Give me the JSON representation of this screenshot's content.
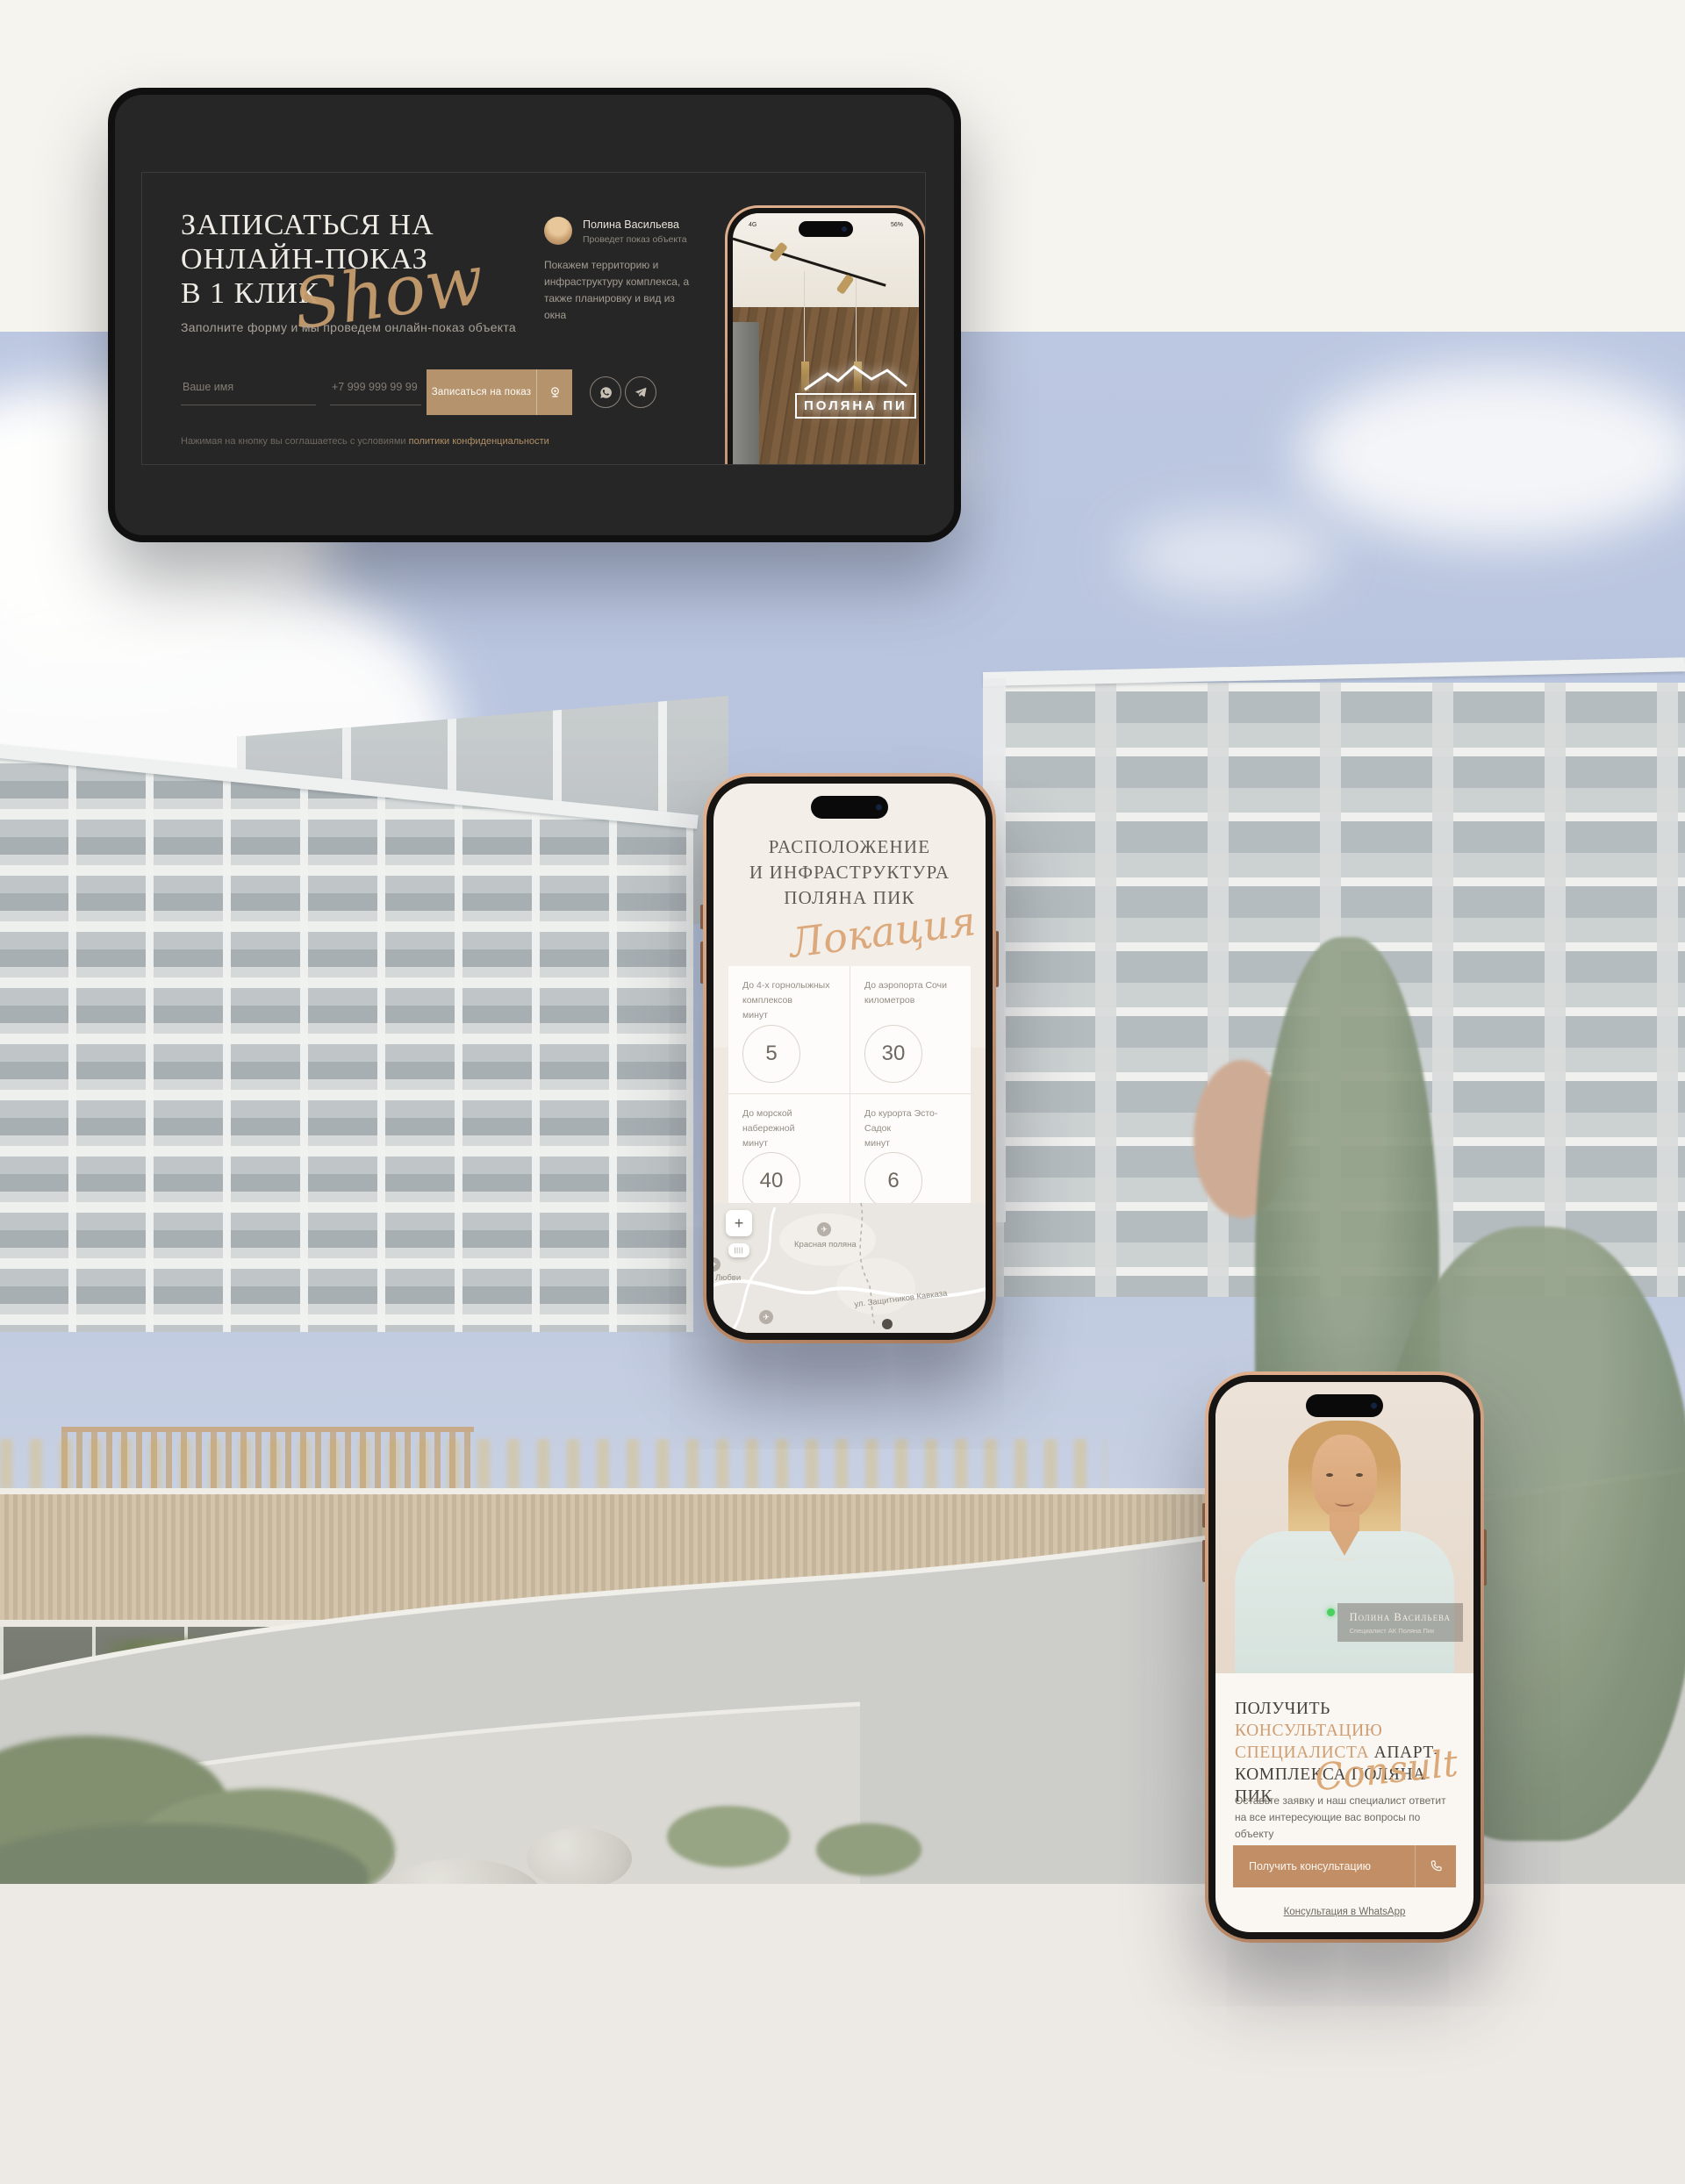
{
  "palette": {
    "accent_gold": "#c59a6d",
    "card_bg": "#262626",
    "sky": "#aebcda",
    "cream": "#f6f4ef",
    "band": "#edeae5",
    "button_tan": "#c28e66"
  },
  "hero_card": {
    "title_line1": "ЗАПИСАТЬСЯ НА",
    "title_line2": "ОНЛАЙН-ПОКАЗ",
    "title_line3": "В 1 КЛИК",
    "script_overlay": "Show",
    "subtitle": "Заполните форму и мы проведем онлайн-показ объекта",
    "form": {
      "name_placeholder": "Ваше имя",
      "phone_placeholder": "+7 999 999 99 99",
      "submit_label": "Записаться на показ"
    },
    "disclaimer_prefix": "Нажимая на кнопку вы соглашаетесь с условиями ",
    "disclaimer_link": "политики конфиденциальности",
    "agent": {
      "name": "Полина Васильева",
      "role": "Проведет показ объекта",
      "description": "Покажем территорию и инфраструктуру комплекса, а также планировку и вид из окна"
    },
    "phone_preview": {
      "status_left": "4G",
      "battery": "56%",
      "sign_text": "ПОЛЯНА ПИ"
    }
  },
  "location_phone": {
    "title_line1": "РАСПОЛОЖЕНИЕ",
    "title_line2": "И ИНФРАСТРУКТУРА",
    "title_line3": "ПОЛЯНА ПИК",
    "script_overlay": "Локация",
    "stats": [
      {
        "label": "До 4-х горнолыжных комплексов",
        "unit": "минут",
        "value": "5"
      },
      {
        "label": "До аэропорта Сочи",
        "unit": "километров",
        "value": "30"
      },
      {
        "label": "До морской набережной",
        "unit": "минут",
        "value": "40"
      },
      {
        "label": "До курорта Эсто-Садок",
        "unit": "минут",
        "value": "6"
      }
    ],
    "map": {
      "zoom_in": "+",
      "label_place": "Красная поляна",
      "label_street": "ул. Защитников Кавказа",
      "label_partial": "Любви",
      "airplane_glyph": "✈"
    }
  },
  "consult_phone": {
    "badge": {
      "name": "Полина Васильева",
      "role": "Специалист АК Поляна Пик"
    },
    "title_dark1": "ПОЛУЧИТЬ ",
    "title_gold": "КОНСУЛЬТАЦИЮ СПЕЦИАЛИСТА",
    "title_dark2": " АПАРТ-КОМПЛЕКСА ПОЛЯНА ПИК",
    "script_overlay": "Consult",
    "description": "Оставьте заявку и наш специалист ответит на все интересующие вас вопросы по объекту",
    "button_label": "Получить консультацию",
    "whatsapp_link": "Консультация в WhatsApp"
  }
}
